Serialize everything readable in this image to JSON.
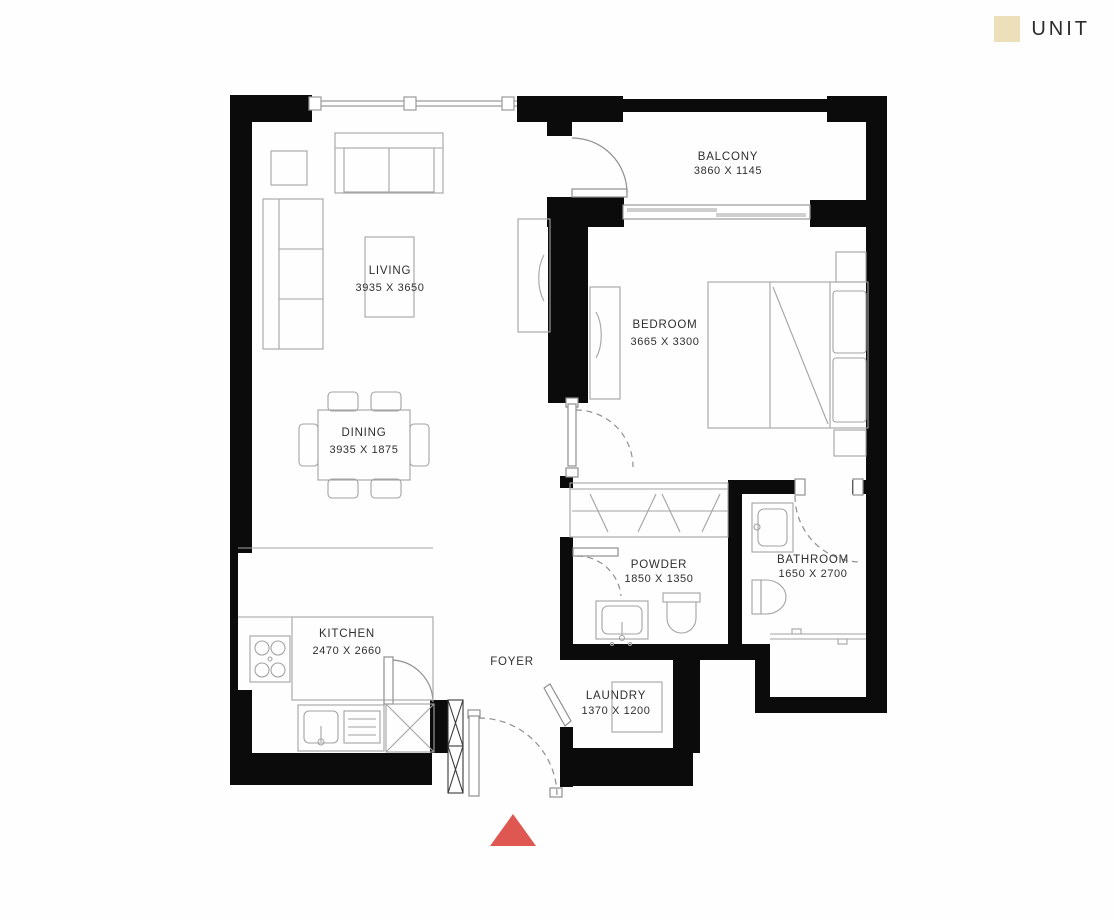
{
  "legend": {
    "unit_label": "UNIT",
    "unit_swatch_color": "#ece0ba"
  },
  "rooms": {
    "living": {
      "name": "LIVING",
      "dims": "3935 X 3650"
    },
    "dining": {
      "name": "DINING",
      "dims": "3935 X 1875"
    },
    "bedroom": {
      "name": "BEDROOM",
      "dims": "3665 X 3300"
    },
    "balcony": {
      "name": "BALCONY",
      "dims": "3860 X 1145"
    },
    "kitchen": {
      "name": "KITCHEN",
      "dims": "2470 X 2660"
    },
    "powder": {
      "name": "POWDER",
      "dims": "1850 X 1350"
    },
    "bathroom": {
      "name": "BATHROOM",
      "dims": "1650 X 2700"
    },
    "laundry": {
      "name": "LAUNDRY",
      "dims": "1370 X 1200"
    },
    "foyer": {
      "name": "FOYER"
    }
  },
  "markers": {
    "wall_color": "#0b0b0b",
    "entrance_arrow_color": "#de5750"
  }
}
